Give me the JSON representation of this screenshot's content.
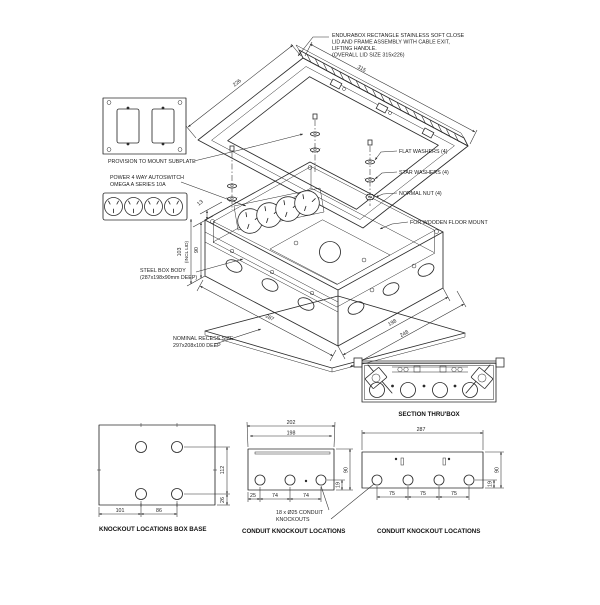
{
  "note": {
    "lines": [
      "ENDURABOX RECTANGLE STAINLESS SOFT CLOSE",
      "LID AND FRAME ASSEMBLY WITH CABLE EXIT,",
      "LIFTING HANDLE.",
      "(OVERALL LID SIZE 315x226)"
    ]
  },
  "labels": {
    "subplate": "PROVISION TO MOUNT SUBPLATE",
    "power_line1": "POWER 4 WAY AUTOSWITCH",
    "power_line2": "OMEGA A SERIES 10A",
    "flat_washers": "FLAT WASHERS (4)",
    "star_washers": "STAR WASHERS (4)",
    "normal_nut": "NORMAL NUT (4)",
    "wooden_floor": "FOR WOODEN FLOOR MOUNT",
    "steel_box_line1": "STEEL BOX BODY",
    "steel_box_line2": "(287x198x90mm DEEP)",
    "recess_line1": "NOMINAL RECESS SIZE",
    "recess_line2": "297x208x100 DEEP",
    "section_label": "SECTION THRU'BOX",
    "base_label": "KNOCKOUT LOCATIONS BOX BASE",
    "conduit_label_mid": "CONDUIT KNOCKOUT LOCATIONS",
    "conduit_label_right": "CONDUIT KNOCKOUT LOCATIONS",
    "conduit_callout_line1": "18 x Ø25 CONDUIT",
    "conduit_callout_line2": "KNOCKOUTS"
  },
  "dims": {
    "lid_depth": "226",
    "lid_width": "315",
    "lid_h": "13",
    "overall_h": "103",
    "overall_h_note": "(INCL LID)",
    "box_h": "90",
    "box_len": "287",
    "box_wid": "198",
    "flange_wid": "248",
    "base_101": "101",
    "base_86": "86",
    "base_112": "112",
    "base_26": "26",
    "mid_202": "202",
    "mid_198": "198",
    "mid_25": "25",
    "mid_74a": "74",
    "mid_74b": "74",
    "mid_90": "90",
    "mid_19": "19",
    "right_287": "287",
    "right_75a": "75",
    "right_75b": "75",
    "right_75c": "75",
    "right_90": "90",
    "right_19": "19"
  }
}
